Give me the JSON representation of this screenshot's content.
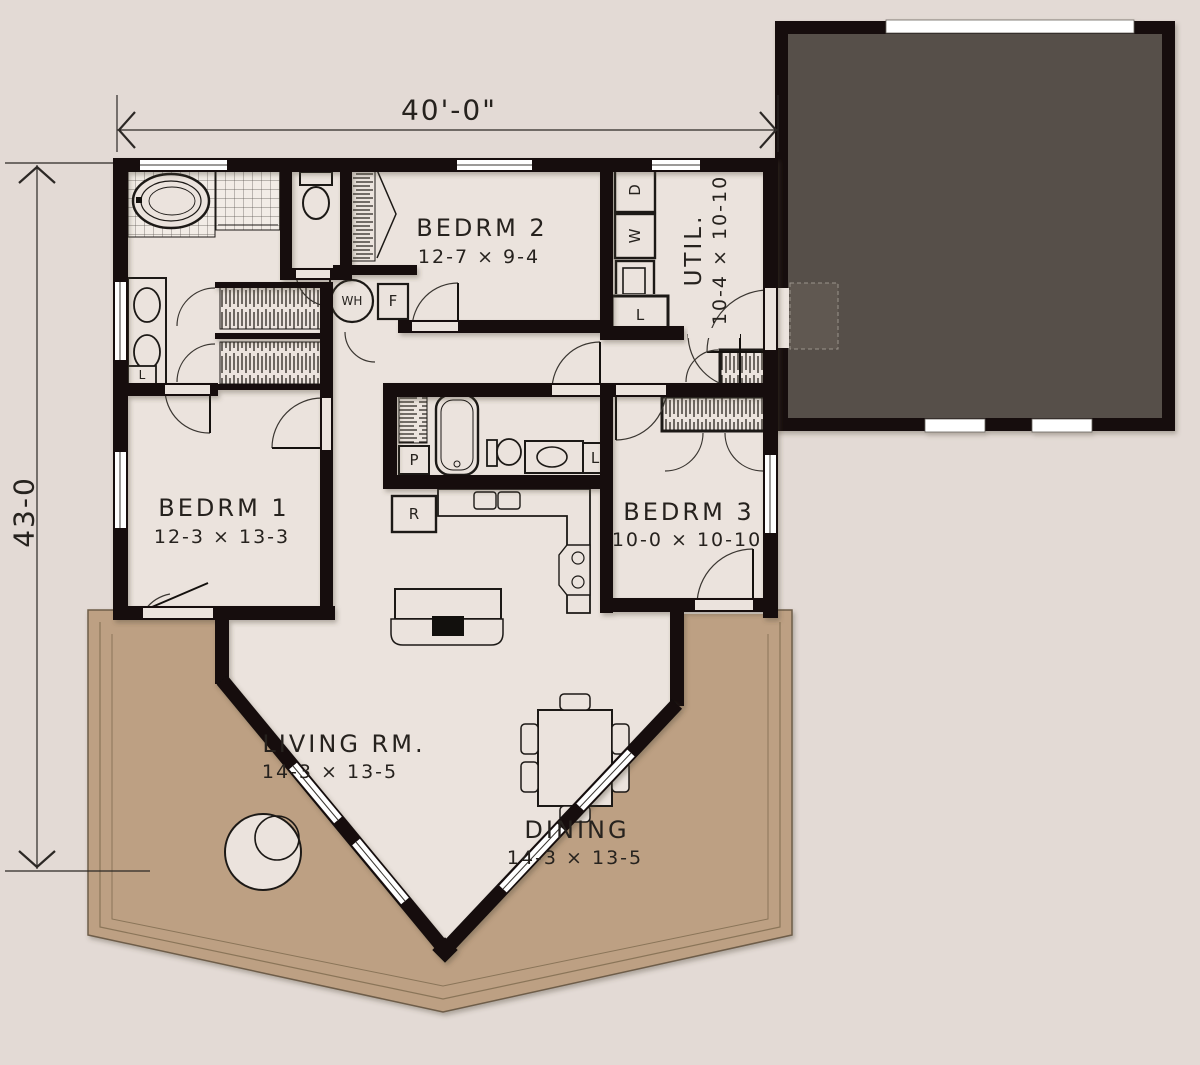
{
  "plan": {
    "dimensions": {
      "width": "40'-0\"",
      "depth": "43-0"
    },
    "rooms": [
      {
        "name": "BEDRM 2",
        "size": "12-7 × 9-4"
      },
      {
        "name": "UTIL.",
        "size": "10-4 × 10-10"
      },
      {
        "name": "BEDRM 1",
        "size": "12-3 × 13-3"
      },
      {
        "name": "BEDRM 3",
        "size": "10-0 × 10-10"
      },
      {
        "name": "LIVING RM.",
        "size": "14-3 × 13-5"
      },
      {
        "name": "DINING",
        "size": "14-3 × 13-5"
      }
    ],
    "fixture_labels": {
      "dryer": "D",
      "washer": "W",
      "water_heater": "WH",
      "furnace": "F",
      "refrigerator": "R",
      "pantry": "P",
      "linen": "L"
    },
    "colors": {
      "background": "#e3dad5",
      "floor": "#ebe3dd",
      "deck": "#bda083",
      "garage": "#57504a",
      "walls": "#12100d"
    }
  }
}
